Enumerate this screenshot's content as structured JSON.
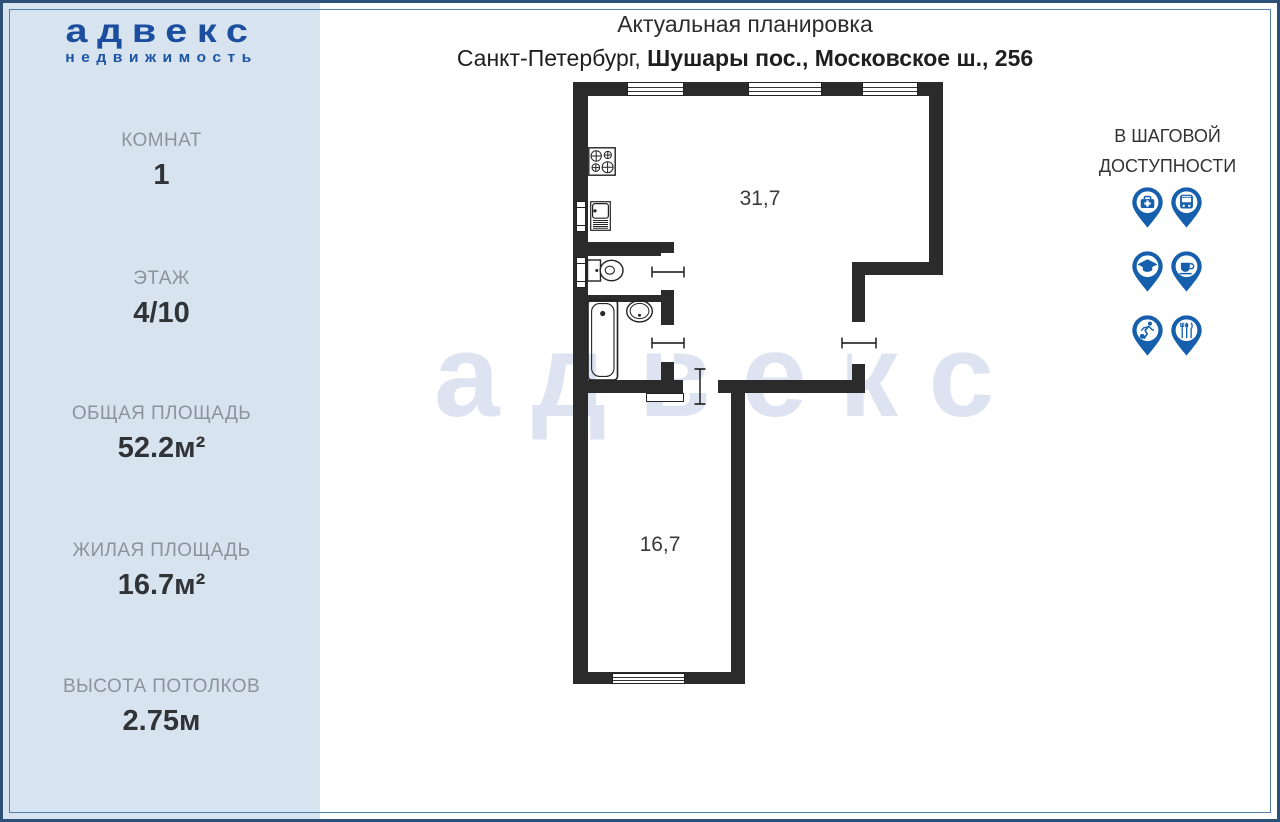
{
  "logo": {
    "brand": "адвекс",
    "tagline": "недвижимость"
  },
  "sidebar": {
    "stats": [
      {
        "label": "КОМНАТ",
        "value": "1"
      },
      {
        "label": "ЭТАЖ",
        "value": "4/10"
      },
      {
        "label": "ОБЩАЯ ПЛОЩАДЬ",
        "value": "52.2м²"
      },
      {
        "label": "ЖИЛАЯ ПЛОЩАДЬ",
        "value": "16.7м²"
      },
      {
        "label": "ВЫСОТА ПОТОЛКОВ",
        "value": "2.75м"
      }
    ]
  },
  "header": {
    "title": "Актуальная планировка",
    "address_prefix": "Санкт-Петербург, ",
    "address_bold": "Шушары пос., Московское ш., 256"
  },
  "walkable": {
    "title_line1": "В ШАГОВОЙ",
    "title_line2": "ДОСТУПНОСТИ",
    "icons": [
      "medical-pin",
      "bus-pin",
      "education-pin",
      "cafe-pin",
      "sport-pin",
      "restaurant-pin"
    ]
  },
  "plan": {
    "watermark": "адвекс",
    "rooms": [
      {
        "name": "living-kitchen",
        "area": "31,7"
      },
      {
        "name": "bedroom",
        "area": "16,7"
      }
    ]
  },
  "colors": {
    "sidebar_bg": "#d7e3ee",
    "logo_blue": "#1b4e9e",
    "pin_blue": "#155fac",
    "wall": "#2b2b2b",
    "watermark": "#dde3f1",
    "frame_outer": "#2d5176",
    "frame_inner": "#4e80ae"
  }
}
